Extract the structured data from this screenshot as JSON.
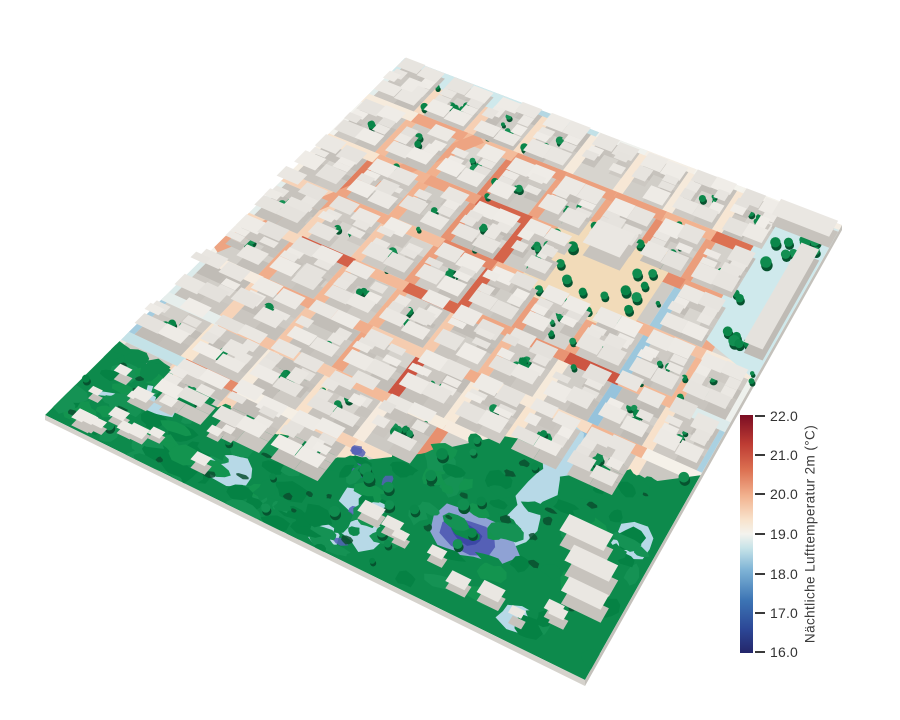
{
  "figure": {
    "background": "#ffffff",
    "description": "3D city model colored by nighttime air temperature"
  },
  "legend": {
    "title": "Nächtliche Lufttemperatur 2m (°C)",
    "ticks": [
      "22.0",
      "21.0",
      "20.0",
      "19.0",
      "18.0",
      "17.0",
      "16.0"
    ],
    "range": [
      16,
      22
    ],
    "colormap": [
      {
        "t": 0.0,
        "c": "#24266a"
      },
      {
        "t": 0.1,
        "c": "#2c4796"
      },
      {
        "t": 0.22,
        "c": "#3c74b4"
      },
      {
        "t": 0.35,
        "c": "#7fb4d6"
      },
      {
        "t": 0.44,
        "c": "#c6e3e8"
      },
      {
        "t": 0.5,
        "c": "#f4f3ee"
      },
      {
        "t": 0.56,
        "c": "#f8e3cc"
      },
      {
        "t": 0.66,
        "c": "#f2b28f"
      },
      {
        "t": 0.77,
        "c": "#dc7051"
      },
      {
        "t": 0.88,
        "c": "#bd3b33"
      },
      {
        "t": 1.0,
        "c": "#7b0d23"
      }
    ]
  },
  "scene": {
    "quad": {
      "n": [
        405,
        58
      ],
      "e": [
        842,
        225
      ],
      "s": [
        585,
        680
      ],
      "w": [
        45,
        415
      ]
    },
    "grid": 9,
    "seed": 7,
    "street_halfwidth": 0.011,
    "corridor_u": 0.778,
    "park_boundary": [
      [
        0,
        0.8
      ],
      [
        0.15,
        0.83
      ],
      [
        0.3,
        0.83
      ],
      [
        0.45,
        0.82
      ],
      [
        0.55,
        0.74
      ],
      [
        0.65,
        0.64
      ],
      [
        0.78,
        0.6
      ],
      [
        0.9,
        0.62
      ],
      [
        1.0,
        0.55
      ]
    ],
    "plaza": {
      "u0": 0.5,
      "v0": 0.175,
      "u1": 0.74,
      "v1": 0.36
    },
    "pond": {
      "u": 0.71,
      "v": 0.84
    },
    "diagonal_street": {
      "from": [
        0.0,
        0.53
      ],
      "to": [
        0.25,
        0.1
      ]
    },
    "palette": {
      "ground_base": "#ece6df",
      "courtyard": "#d2cfc9",
      "roof": "#eae7e2",
      "wall": "#c7c3bd",
      "tree": "#0e8a4d",
      "tree_dark": "#06532f",
      "tree_light": "#13944f",
      "park": "#0d8a4c",
      "park_dark": "#0a4f2f",
      "pond_deep": "#3c47a6",
      "pond_mid": "#5560b6",
      "pond_light": "#8fa2d4",
      "cool_light": "#b7d9e7",
      "pale_cyan": "#cfe9ec",
      "plaza_ground": "#f2dbb9",
      "skirt": "#d5d2cc",
      "skirt_dark": "#c4c1bb"
    }
  }
}
